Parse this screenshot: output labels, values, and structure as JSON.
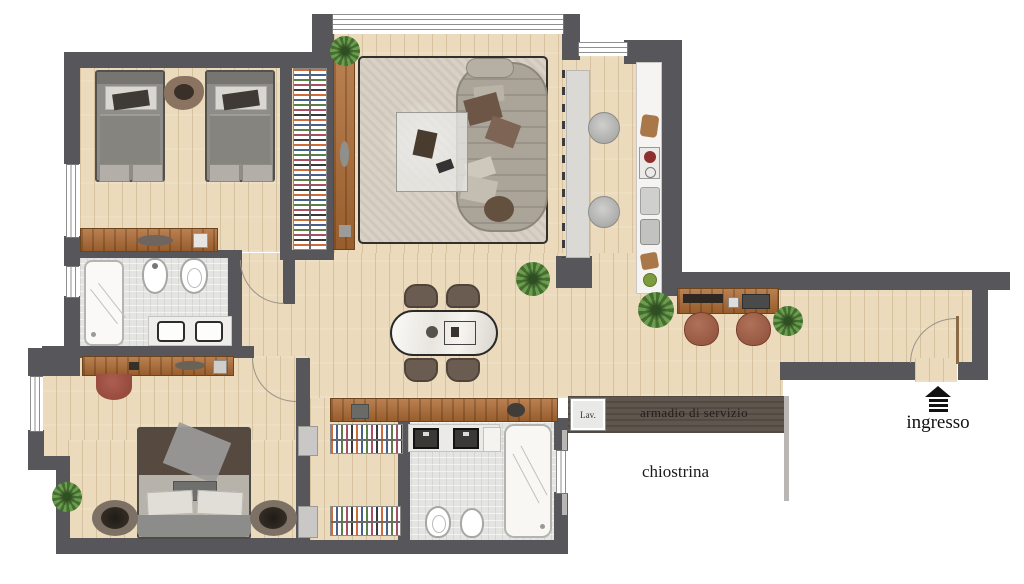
{
  "plan": {
    "labels": {
      "laundry": "Lav.",
      "service_wardrobe": "armadio di servizio",
      "courtyard": "chiostrina",
      "entrance": "ingresso"
    },
    "colors": {
      "wall": "#57565a",
      "wood_floor": "#ebdbbc",
      "wood_furniture": "#ad6a33",
      "tile_floor": "#e4e4e2",
      "service_band": "#5f574e",
      "rug": "#d9d1c5",
      "plant": "#6d9b50",
      "label_text": "#1d1b19"
    }
  }
}
